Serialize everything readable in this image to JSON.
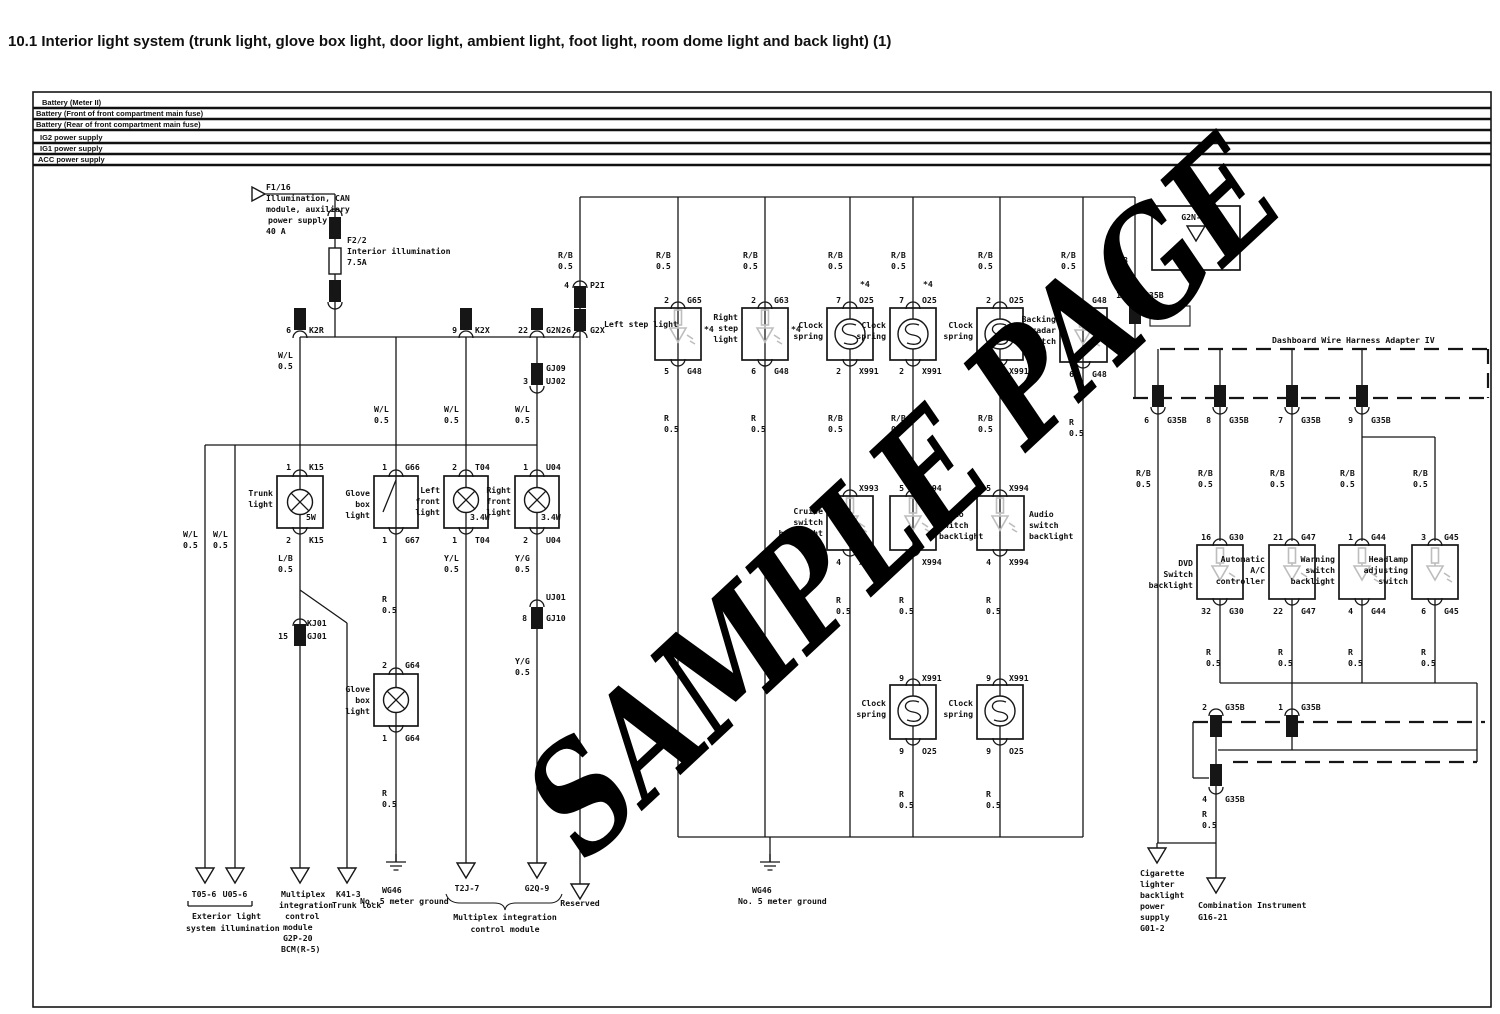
{
  "title": "10.1 Interior light system (trunk light, glove box light, door light, ambient light, foot light, room dome light and back light) (1)",
  "watermark": "SAMPLE PAGE",
  "rails": {
    "battery_meter": "Battery (Meter II)",
    "battery_front": "Battery (Front of front compartment main fuse)",
    "battery_rear": "Battery (Rear of front compartment main fuse)",
    "ig2": "IG2 power supply",
    "ig1": "IG1 power supply",
    "acc": "ACC power supply"
  },
  "fuses": {
    "f116": {
      "id": "F1/16",
      "d1": "Illumination, CAN",
      "d2": "module, auxiliary",
      "d3": "power supply",
      "rating": "40 A"
    },
    "f22": {
      "id": "F2/2",
      "d": "Interior illumination",
      "rating": "7.5A"
    }
  },
  "wire": {
    "wl": "W/L",
    "lb": "L/B",
    "yl": "Y/L",
    "yg": "Y/G",
    "r": "R",
    "rb": "R/B",
    "sz": "0.5"
  },
  "note": "*4",
  "conn": {
    "k2r": {
      "p": "6",
      "n": "K2R"
    },
    "k2x": {
      "p": "9",
      "n": "K2X"
    },
    "g2n": {
      "p": "22",
      "n": "G2N"
    },
    "g2x": {
      "p": "26",
      "n": "G2X"
    },
    "p2i": {
      "p": "4",
      "n": "P2I"
    },
    "gj09": {
      "p": "3",
      "a": "GJ09",
      "b": "UJ02"
    },
    "uj01": {
      "p": "8",
      "a": "UJ01",
      "b": "GJ10"
    },
    "kj01": {
      "p": "15",
      "a": "KJ01",
      "b": "GJ01"
    },
    "g2n35": "G2N-35",
    "g35b10": {
      "p": "10",
      "n": "G35B"
    },
    "g35b6": {
      "p": "6",
      "n": "G35B"
    },
    "g35b8": {
      "p": "8",
      "n": "G35B"
    },
    "g35b7": {
      "p": "7",
      "n": "G35B"
    },
    "g35b9": {
      "p": "9",
      "n": "G35B"
    },
    "g35b2": {
      "p": "2",
      "n": "G35B"
    },
    "g35b1": {
      "p": "1",
      "n": "G35B"
    },
    "g35b4": {
      "p": "4",
      "n": "G35B"
    }
  },
  "comp": {
    "trunk": {
      "l1": "Trunk",
      "l2": "light",
      "watt": "5W",
      "pt": "1",
      "ct": "K15",
      "pb": "2",
      "cb": "K15"
    },
    "glove_sw": {
      "l1": "Glove",
      "l2": "box",
      "l3": "light",
      "pt": "1",
      "ct": "G66",
      "pb": "1",
      "cb": "G67"
    },
    "left_front": {
      "l1": "Left",
      "l2": "front",
      "l3": "light",
      "watt": "3.4W",
      "pt": "2",
      "ct": "T04",
      "pb": "1",
      "cb": "T04"
    },
    "right_front": {
      "l1": "Right",
      "l2": "front",
      "l3": "light",
      "watt": "3.4W",
      "pt": "1",
      "ct": "U04",
      "pb": "2",
      "cb": "U04"
    },
    "glove_lamp": {
      "l1": "Glove",
      "l2": "box",
      "l3": "light",
      "pt": "2",
      "ct": "G64",
      "pb": "1",
      "cb": "G64"
    },
    "step_l": {
      "l1": "Left step light",
      "pt": "2",
      "ct": "G65",
      "pb": "5",
      "cb": "G48"
    },
    "step_r": {
      "l1": "Right",
      "l2": "step",
      "l3": "light",
      "pt": "2",
      "ct": "G63",
      "pb": "6",
      "cb": "G48"
    },
    "cs1": {
      "l1": "Clock",
      "l2": "spring",
      "pt": "7",
      "ct": "O25",
      "pb": "2",
      "cb": "X991"
    },
    "cs2": {
      "l1": "Clock",
      "l2": "spring",
      "pt": "7",
      "ct": "O25",
      "pb": "2",
      "cb": "X991"
    },
    "cs3": {
      "l1": "Clock",
      "l2": "spring",
      "pt": "2",
      "ct": "O25",
      "pb": "2",
      "cb": "X991"
    },
    "back_sw": {
      "l1": "Backing",
      "l2": "radar",
      "l3": "switch",
      "pt": "3",
      "ct": "G48",
      "pb": "6",
      "cb": "G48"
    },
    "cruise": {
      "l1": "Cruise",
      "l2": "switch",
      "l3": "backlight",
      "pt": "2",
      "ct": "X993",
      "pb": "4",
      "cb": "X993"
    },
    "audio1": {
      "l1": "Audio",
      "l2": "switch",
      "l3": "backlight",
      "pt": "5",
      "ct": "X994",
      "pb": "4",
      "cb": "X994"
    },
    "audio2": {
      "l1": "Audio",
      "l2": "switch",
      "l3": "backlight",
      "pt": "5",
      "ct": "X994",
      "pb": "4",
      "cb": "X994"
    },
    "cs4": {
      "l1": "Clock",
      "l2": "spring",
      "pt": "9",
      "ct": "X991",
      "pb": "9",
      "cb": "O25"
    },
    "cs5": {
      "l1": "Clock",
      "l2": "spring",
      "pt": "9",
      "ct": "X991",
      "pb": "9",
      "cb": "O25"
    },
    "dvd": {
      "l1": "DVD",
      "l2": "Switch",
      "l3": "backlight",
      "pt": "16",
      "ct": "G30",
      "pb": "32",
      "cb": "G30"
    },
    "ac": {
      "l1": "Automatic",
      "l2": "A/C",
      "l3": "controller",
      "pt": "21",
      "ct": "G47",
      "pb": "22",
      "cb": "G47"
    },
    "warning": {
      "l1": "Warning",
      "l2": "switch",
      "l3": "backlight",
      "pt": "1",
      "ct": "G44",
      "pb": "4",
      "cb": "G44"
    },
    "headlamp": {
      "l1": "Headlamp",
      "l2": "adjusting",
      "l3": "switch",
      "pt": "3",
      "ct": "G45",
      "pb": "6",
      "cb": "G45"
    }
  },
  "adapter": "Dashboard Wire Harness Adapter IV",
  "ground": {
    "id": "WG46",
    "label": "No. 5 meter ground"
  },
  "dest": {
    "t05": "T05-6",
    "u05": "U05-6",
    "ext1": "Exterior light",
    "ext2": "system illumination",
    "mux": {
      "l1": "Multiplex",
      "l2": "integration",
      "l3": "control",
      "l4": "module",
      "l5": "G2P-20",
      "l6": "BCM(R-5)"
    },
    "trunk_lock": {
      "id": "K41-3",
      "label": "Trunk lock"
    },
    "t2j": "T2J-7",
    "g2q": "G2Q-9",
    "mic1": "Multiplex integration",
    "mic2": "control module",
    "reserved": "Reserved",
    "cig": {
      "l1": "Cigarette",
      "l2": "lighter",
      "l3": "backlight",
      "l4": "power",
      "l5": "supply",
      "l6": "G01-2"
    },
    "combi": {
      "l1": "Combination Instrument",
      "l2": "G16-21"
    }
  }
}
